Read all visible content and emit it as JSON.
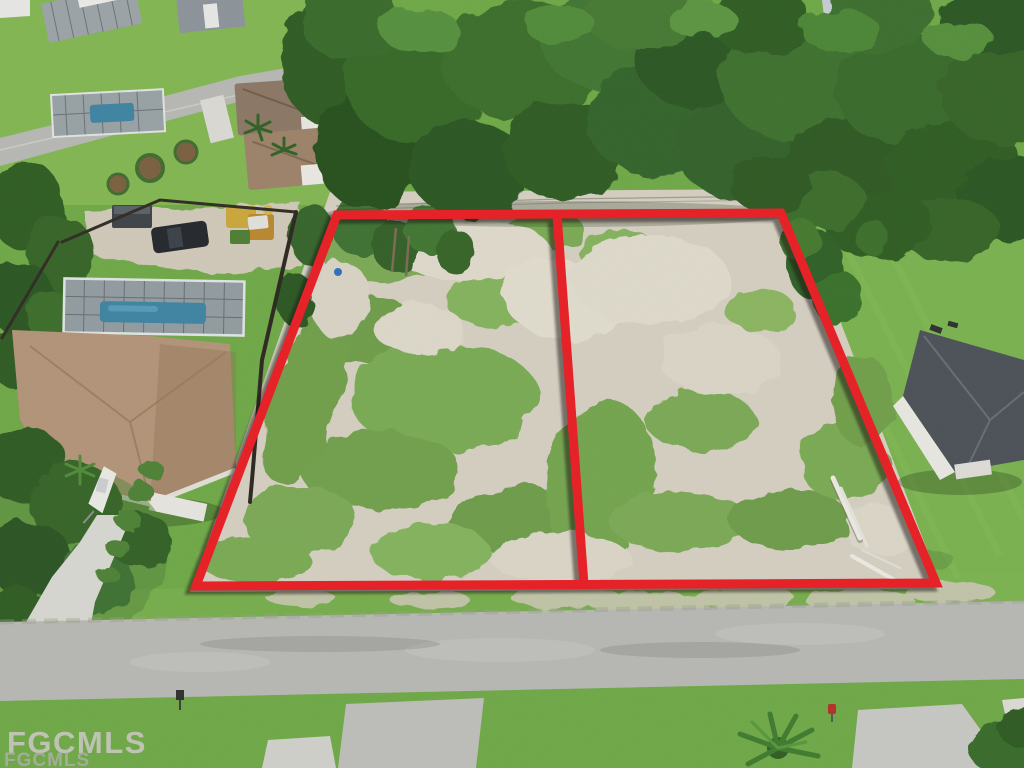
{
  "photo": {
    "type": "aerial-drone-real-estate-photo",
    "subject": "Two adjacent vacant residential lots outlined in red in a suburban neighborhood with homes, pools, streets and trees",
    "lot_count": 2,
    "watermark_primary": "FGCMLS",
    "watermark_secondary": "FGCMLS"
  },
  "colors": {
    "boundary_red": "#e71d23",
    "boundary_shadow": "#171008",
    "grass": "#6da746",
    "lawn_light": "#82b551",
    "tree_dark": "#2e5a23",
    "sand": "#d3cec0",
    "road": "#b6b7b3",
    "pool_blue": "#3d83a2",
    "roof_tan": "#b19377",
    "roof_dark": "#4a5056",
    "watermark": "#c6c6be"
  }
}
